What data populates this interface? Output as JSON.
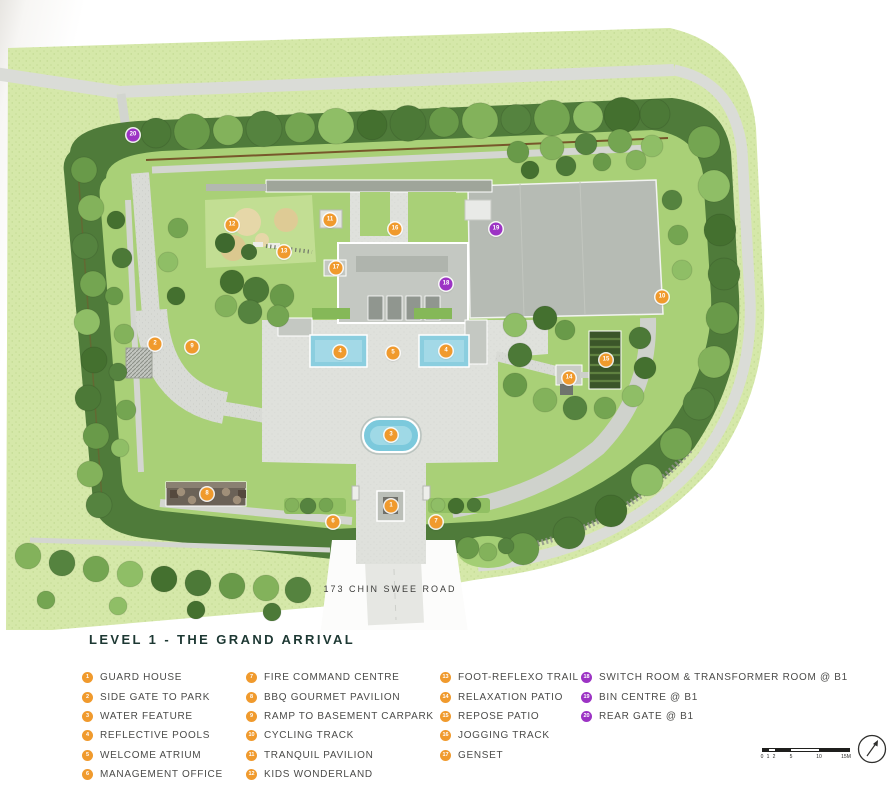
{
  "title": "LEVEL 1 - THE GRAND ARRIVAL",
  "road_label": "173 CHIN SWEE ROAD",
  "colors": {
    "marker_orange": "#F09A2D",
    "marker_purple": "#9C33C4",
    "title_text": "#1D3833",
    "legend_text": "#4B4B49",
    "lawn": "#D5E8A9",
    "hedge": "#4F7B3A",
    "pool_blue": "#8BCEDF"
  },
  "legend": {
    "columns": [
      {
        "items": [
          {
            "num": "1",
            "label": "GUARD HOUSE",
            "color": "orange"
          },
          {
            "num": "2",
            "label": "SIDE GATE TO PARK",
            "color": "orange"
          },
          {
            "num": "3",
            "label": "WATER FEATURE",
            "color": "orange"
          },
          {
            "num": "4",
            "label": "REFLECTIVE POOLS",
            "color": "orange"
          },
          {
            "num": "5",
            "label": "WELCOME ATRIUM",
            "color": "orange"
          },
          {
            "num": "6",
            "label": "MANAGEMENT OFFICE",
            "color": "orange"
          }
        ]
      },
      {
        "items": [
          {
            "num": "7",
            "label": "FIRE COMMAND CENTRE",
            "color": "orange"
          },
          {
            "num": "8",
            "label": "BBQ GOURMET PAVILION",
            "color": "orange"
          },
          {
            "num": "9",
            "label": "RAMP TO BASEMENT CARPARK",
            "color": "orange"
          },
          {
            "num": "10",
            "label": "CYCLING TRACK",
            "color": "orange"
          },
          {
            "num": "11",
            "label": "TRANQUIL PAVILION",
            "color": "orange"
          },
          {
            "num": "12",
            "label": "KIDS WONDERLAND",
            "color": "orange"
          }
        ]
      },
      {
        "items": [
          {
            "num": "13",
            "label": "FOOT-REFLEXO TRAIL",
            "color": "orange"
          },
          {
            "num": "14",
            "label": "RELAXATION PATIO",
            "color": "orange"
          },
          {
            "num": "15",
            "label": "REPOSE PATIO",
            "color": "orange"
          },
          {
            "num": "16",
            "label": "JOGGING TRACK",
            "color": "orange"
          },
          {
            "num": "17",
            "label": "GENSET",
            "color": "orange"
          }
        ]
      },
      {
        "items": [
          {
            "num": "18",
            "label": "SWITCH ROOM & TRANSFORMER ROOM @ B1",
            "color": "purple"
          },
          {
            "num": "19",
            "label": "BIN CENTRE @ B1",
            "color": "purple"
          },
          {
            "num": "20",
            "label": "REAR GATE @ B1",
            "color": "purple"
          }
        ]
      }
    ]
  },
  "map": {
    "markers": [
      {
        "num": "1",
        "x": 391,
        "y": 506,
        "color": "orange"
      },
      {
        "num": "2",
        "x": 155,
        "y": 344,
        "color": "orange"
      },
      {
        "num": "3",
        "x": 391,
        "y": 435,
        "color": "orange"
      },
      {
        "num": "4",
        "x": 340,
        "y": 352,
        "color": "orange"
      },
      {
        "num": "4",
        "x": 446,
        "y": 351,
        "color": "orange"
      },
      {
        "num": "5",
        "x": 393,
        "y": 353,
        "color": "orange"
      },
      {
        "num": "6",
        "x": 333,
        "y": 522,
        "color": "orange"
      },
      {
        "num": "7",
        "x": 436,
        "y": 522,
        "color": "orange"
      },
      {
        "num": "8",
        "x": 207,
        "y": 494,
        "color": "orange"
      },
      {
        "num": "9",
        "x": 192,
        "y": 347,
        "color": "orange"
      },
      {
        "num": "10",
        "x": 662,
        "y": 297,
        "color": "orange"
      },
      {
        "num": "11",
        "x": 330,
        "y": 220,
        "color": "orange"
      },
      {
        "num": "12",
        "x": 232,
        "y": 225,
        "color": "orange"
      },
      {
        "num": "13",
        "x": 284,
        "y": 252,
        "color": "orange"
      },
      {
        "num": "14",
        "x": 569,
        "y": 378,
        "color": "orange"
      },
      {
        "num": "15",
        "x": 606,
        "y": 360,
        "color": "orange"
      },
      {
        "num": "16",
        "x": 395,
        "y": 229,
        "color": "orange"
      },
      {
        "num": "17",
        "x": 336,
        "y": 268,
        "color": "orange"
      },
      {
        "num": "18",
        "x": 446,
        "y": 284,
        "color": "purple"
      },
      {
        "num": "19",
        "x": 496,
        "y": 229,
        "color": "purple"
      },
      {
        "num": "20",
        "x": 133,
        "y": 135,
        "color": "purple"
      }
    ]
  },
  "scale_bar": {
    "labels": [
      "0",
      "1",
      "2",
      "5",
      "10",
      "15M"
    ]
  }
}
